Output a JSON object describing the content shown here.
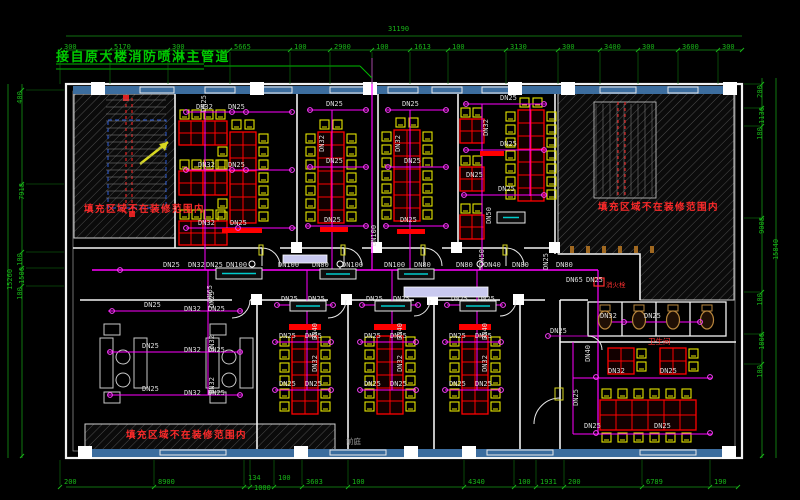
{
  "title": "接自原大楼消防喷淋主管道",
  "notes": {
    "hatch": "填充区域不在装修范围内",
    "toilet": "卫生间",
    "hydrant": "消火栓",
    "lobby": "前庭"
  },
  "colors": {
    "background": "#000000",
    "dimension_green": "#18b418",
    "pipe_magenta": "#ff00ff",
    "table_red": "#ff0000",
    "chair_yellow": "#e6e600",
    "wall_white": "#f2f2f2",
    "window_band_blue": "#3c6d9e",
    "note_red": "#ff2a2a"
  },
  "dimensions": {
    "top_total": "31190",
    "left_total": "15260",
    "right_total": "15840",
    "top": [
      {
        "v": "300",
        "x": 64
      },
      {
        "v": "5170",
        "x": 114
      },
      {
        "v": "300",
        "x": 172
      },
      {
        "v": "5665",
        "x": 234
      },
      {
        "v": "100",
        "x": 294
      },
      {
        "v": "2900",
        "x": 334
      },
      {
        "v": "100",
        "x": 376
      },
      {
        "v": "1613",
        "x": 414
      },
      {
        "v": "100",
        "x": 452
      },
      {
        "v": "3130",
        "x": 510
      },
      {
        "v": "300",
        "x": 562
      },
      {
        "v": "3400",
        "x": 604
      },
      {
        "v": "300",
        "x": 642
      },
      {
        "v": "3600",
        "x": 682
      },
      {
        "v": "300",
        "x": 722
      }
    ],
    "bottom": [
      {
        "v": "200",
        "x": 64,
        "y": 479
      },
      {
        "v": "8900",
        "x": 158,
        "y": 479
      },
      {
        "v": "134",
        "x": 248,
        "y": 475
      },
      {
        "v": "1000",
        "x": 254,
        "y": 485
      },
      {
        "v": "100",
        "x": 278,
        "y": 475
      },
      {
        "v": "3603",
        "x": 306,
        "y": 479
      },
      {
        "v": "100",
        "x": 352,
        "y": 479
      },
      {
        "v": "4340",
        "x": 468,
        "y": 479
      },
      {
        "v": "100",
        "x": 518,
        "y": 479
      },
      {
        "v": "1931",
        "x": 540,
        "y": 479
      },
      {
        "v": "200",
        "x": 568,
        "y": 479
      },
      {
        "v": "6789",
        "x": 646,
        "y": 479
      },
      {
        "v": "190",
        "x": 714,
        "y": 479
      }
    ],
    "left": [
      {
        "v": "400",
        "y": 94
      },
      {
        "v": "7918",
        "y": 188
      },
      {
        "v": "100",
        "y": 256
      },
      {
        "v": "1500",
        "y": 272
      },
      {
        "v": "100",
        "y": 290
      }
    ],
    "right": [
      {
        "v": "200",
        "y": 88
      },
      {
        "v": "1130",
        "y": 112
      },
      {
        "v": "180",
        "y": 130
      },
      {
        "v": "9008",
        "y": 222
      },
      {
        "v": "100",
        "y": 296
      },
      {
        "v": "1800",
        "y": 338
      },
      {
        "v": "100",
        "y": 368
      }
    ]
  },
  "pipe_labels": [
    {
      "t": "DN25",
      "x": 163,
      "y": 262
    },
    {
      "t": "DN32",
      "x": 188,
      "y": 262
    },
    {
      "t": "DN25",
      "x": 206,
      "y": 262
    },
    {
      "t": "DN100",
      "x": 226,
      "y": 262
    },
    {
      "t": "DN100",
      "x": 278,
      "y": 262
    },
    {
      "t": "DN80",
      "x": 312,
      "y": 262
    },
    {
      "t": "DN100",
      "x": 342,
      "y": 262
    },
    {
      "t": "DN100",
      "x": 384,
      "y": 262
    },
    {
      "t": "DN80",
      "x": 414,
      "y": 262
    },
    {
      "t": "DN80",
      "x": 456,
      "y": 262
    },
    {
      "t": "DN40",
      "x": 484,
      "y": 262
    },
    {
      "t": "DN80",
      "x": 512,
      "y": 262
    },
    {
      "t": "DN80",
      "x": 556,
      "y": 262
    },
    {
      "t": "DN65",
      "x": 566,
      "y": 277
    },
    {
      "t": "DN25",
      "x": 586,
      "y": 277
    },
    {
      "t": "DN65",
      "x": 202,
      "y": 290,
      "r": 1
    },
    {
      "t": "DN50",
      "x": 474,
      "y": 254,
      "r": 1
    },
    {
      "t": "DN25",
      "x": 538,
      "y": 258,
      "r": 1
    },
    {
      "t": "DN100",
      "x": 364,
      "y": 232,
      "r": 1
    },
    {
      "t": "DN25",
      "x": 196,
      "y": 100,
      "r": 1
    },
    {
      "t": "DN32",
      "x": 196,
      "y": 104
    },
    {
      "t": "DN25",
      "x": 228,
      "y": 104
    },
    {
      "t": "DN32",
      "x": 198,
      "y": 162
    },
    {
      "t": "DN25",
      "x": 228,
      "y": 162
    },
    {
      "t": "DN32",
      "x": 198,
      "y": 220
    },
    {
      "t": "DN25",
      "x": 230,
      "y": 220
    },
    {
      "t": "DN25",
      "x": 326,
      "y": 101
    },
    {
      "t": "DN25",
      "x": 326,
      "y": 158
    },
    {
      "t": "DN25",
      "x": 324,
      "y": 217
    },
    {
      "t": "DN32",
      "x": 314,
      "y": 140,
      "r": 1
    },
    {
      "t": "DN25",
      "x": 402,
      "y": 101
    },
    {
      "t": "DN25",
      "x": 404,
      "y": 158
    },
    {
      "t": "DN25",
      "x": 400,
      "y": 217
    },
    {
      "t": "DN32",
      "x": 390,
      "y": 140,
      "r": 1
    },
    {
      "t": "DN25",
      "x": 500,
      "y": 95
    },
    {
      "t": "DN25",
      "x": 500,
      "y": 141
    },
    {
      "t": "DN25",
      "x": 466,
      "y": 172
    },
    {
      "t": "DN25",
      "x": 498,
      "y": 186
    },
    {
      "t": "DN32",
      "x": 478,
      "y": 124,
      "r": 1
    },
    {
      "t": "DN50",
      "x": 481,
      "y": 212,
      "r": 1
    },
    {
      "t": "DN25",
      "x": 144,
      "y": 302
    },
    {
      "t": "DN32",
      "x": 184,
      "y": 306
    },
    {
      "t": "DN25",
      "x": 208,
      "y": 306
    },
    {
      "t": "DN25",
      "x": 142,
      "y": 343
    },
    {
      "t": "DN32",
      "x": 184,
      "y": 347
    },
    {
      "t": "DN25",
      "x": 208,
      "y": 347
    },
    {
      "t": "DN25",
      "x": 142,
      "y": 386
    },
    {
      "t": "DN32",
      "x": 184,
      "y": 390
    },
    {
      "t": "DN25",
      "x": 208,
      "y": 390
    },
    {
      "t": "DN25",
      "x": 204,
      "y": 296,
      "r": 1
    },
    {
      "t": "DN32",
      "x": 204,
      "y": 340,
      "r": 1
    },
    {
      "t": "DN32",
      "x": 204,
      "y": 382,
      "r": 1
    },
    {
      "t": "DN25",
      "x": 281,
      "y": 296
    },
    {
      "t": "DN25",
      "x": 308,
      "y": 296
    },
    {
      "t": "DN25",
      "x": 279,
      "y": 333
    },
    {
      "t": "DN25",
      "x": 305,
      "y": 333
    },
    {
      "t": "DN25",
      "x": 279,
      "y": 381
    },
    {
      "t": "DN25",
      "x": 305,
      "y": 381
    },
    {
      "t": "DN40",
      "x": 307,
      "y": 328,
      "r": 1
    },
    {
      "t": "DN32",
      "x": 307,
      "y": 360,
      "r": 1
    },
    {
      "t": "DN25",
      "x": 366,
      "y": 296
    },
    {
      "t": "DN25",
      "x": 393,
      "y": 296
    },
    {
      "t": "DN25",
      "x": 364,
      "y": 333
    },
    {
      "t": "DN25",
      "x": 390,
      "y": 333
    },
    {
      "t": "DN25",
      "x": 364,
      "y": 381
    },
    {
      "t": "DN25",
      "x": 390,
      "y": 381
    },
    {
      "t": "DN40",
      "x": 392,
      "y": 328,
      "r": 1
    },
    {
      "t": "DN32",
      "x": 392,
      "y": 360,
      "r": 1
    },
    {
      "t": "DN25",
      "x": 451,
      "y": 296
    },
    {
      "t": "DN25",
      "x": 478,
      "y": 296
    },
    {
      "t": "DN25",
      "x": 449,
      "y": 333
    },
    {
      "t": "DN25",
      "x": 475,
      "y": 333
    },
    {
      "t": "DN25",
      "x": 449,
      "y": 381
    },
    {
      "t": "DN25",
      "x": 475,
      "y": 381
    },
    {
      "t": "DN40",
      "x": 477,
      "y": 328,
      "r": 1
    },
    {
      "t": "DN32",
      "x": 477,
      "y": 360,
      "r": 1
    },
    {
      "t": "DN32",
      "x": 608,
      "y": 368
    },
    {
      "t": "DN25",
      "x": 660,
      "y": 368
    },
    {
      "t": "DN25",
      "x": 584,
      "y": 423
    },
    {
      "t": "DN25",
      "x": 654,
      "y": 423
    },
    {
      "t": "DN40",
      "x": 580,
      "y": 350,
      "r": 1
    },
    {
      "t": "DN25",
      "x": 568,
      "y": 394,
      "r": 1
    },
    {
      "t": "DN25",
      "x": 550,
      "y": 328
    },
    {
      "t": "DN32",
      "x": 600,
      "y": 313
    },
    {
      "t": "DN25",
      "x": 644,
      "y": 313
    }
  ],
  "sprinklers": [
    [
      186,
      112
    ],
    [
      232,
      112
    ],
    [
      186,
      170
    ],
    [
      232,
      170
    ],
    [
      186,
      228
    ],
    [
      238,
      228
    ],
    [
      246,
      112
    ],
    [
      292,
      112
    ],
    [
      246,
      170
    ],
    [
      292,
      170
    ],
    [
      292,
      228
    ],
    [
      310,
      110
    ],
    [
      366,
      110
    ],
    [
      310,
      167
    ],
    [
      366,
      167
    ],
    [
      308,
      226
    ],
    [
      366,
      226
    ],
    [
      388,
      110
    ],
    [
      446,
      110
    ],
    [
      388,
      167
    ],
    [
      446,
      167
    ],
    [
      386,
      226
    ],
    [
      446,
      226
    ],
    [
      466,
      104
    ],
    [
      544,
      104
    ],
    [
      466,
      150
    ],
    [
      544,
      150
    ],
    [
      464,
      195
    ],
    [
      544,
      195
    ],
    [
      112,
      311
    ],
    [
      240,
      311
    ],
    [
      110,
      352
    ],
    [
      240,
      352
    ],
    [
      110,
      395
    ],
    [
      240,
      395
    ],
    [
      277,
      305
    ],
    [
      333,
      305
    ],
    [
      275,
      342
    ],
    [
      331,
      342
    ],
    [
      275,
      390
    ],
    [
      331,
      390
    ],
    [
      362,
      305
    ],
    [
      418,
      305
    ],
    [
      360,
      342
    ],
    [
      416,
      342
    ],
    [
      360,
      390
    ],
    [
      416,
      390
    ],
    [
      447,
      305
    ],
    [
      503,
      305
    ],
    [
      445,
      342
    ],
    [
      501,
      342
    ],
    [
      445,
      390
    ],
    [
      501,
      390
    ],
    [
      596,
      377
    ],
    [
      710,
      377
    ],
    [
      596,
      433
    ],
    [
      710,
      433
    ],
    [
      624,
      322
    ],
    [
      700,
      322
    ],
    [
      120,
      270
    ],
    [
      548,
      336
    ]
  ]
}
